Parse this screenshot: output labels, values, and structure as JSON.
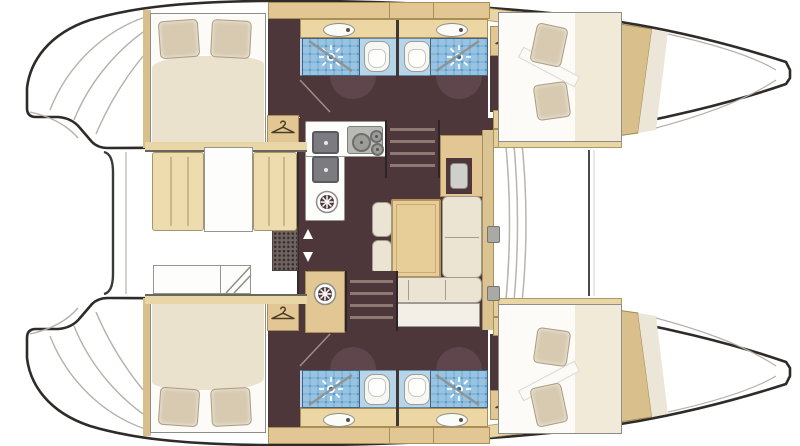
{
  "floorplan": {
    "subject": "catamaran yacht interior layout, top-down deck plan",
    "orientation": {
      "bow": "right",
      "stern": "left",
      "hulls": "top and bottom"
    },
    "inventory": {
      "hulls": 2,
      "double_cabins": 4,
      "bathrooms": 4,
      "showers": 4,
      "toilets": 4,
      "washbasins": 4,
      "wardrobes": 4,
      "companionway_stairs": 2,
      "salon_dining_table": 1,
      "cockpit_table": 1,
      "nav_station": 1,
      "galley_burners": 3,
      "galley_sinks": 2,
      "round_hatches": 2
    },
    "icons": [
      "shower-spray-icon",
      "hanger-icon",
      "round-hatch-icon",
      "door-arrow-up-icon",
      "door-arrow-down-icon"
    ],
    "colors": {
      "hull_outline": "#2f2b28",
      "floor_dark_brown": "#4d373b",
      "door_swing_brown": "#5e464c",
      "cabinet_tan": "#e2c794",
      "counter_tan": "#ecd6a4",
      "deck_tan": "#e8d6a6",
      "shower_blue": "#5b9ac9",
      "bathroom_floor_blue": "#b7d5e9",
      "cushion_cream": "#ece4d2",
      "cockpit_cushion_tan": "#ecdcae",
      "bed_linen_white": "#fcfbf7",
      "duvet_cream": "#ebe2cd",
      "pillow_tan": "#d7cab1",
      "table_wood": "#e7cd97",
      "appliance_grey": "#b9b9b7"
    }
  }
}
